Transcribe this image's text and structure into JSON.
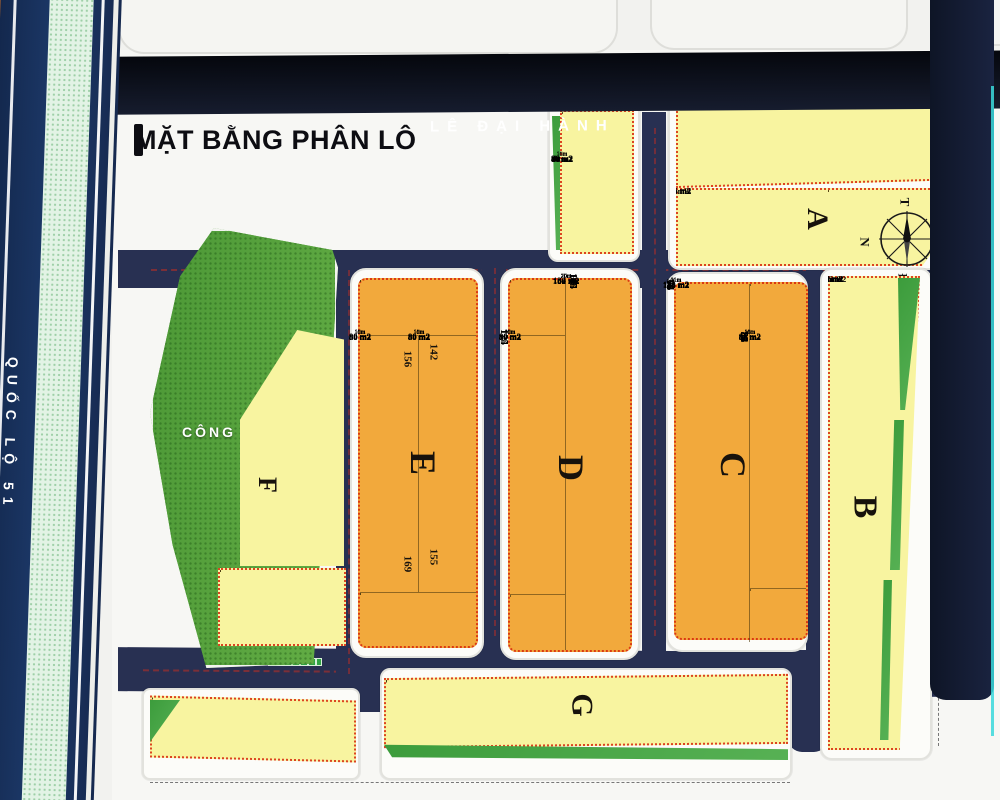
{
  "title": "MẶT BẰNG PHÂN LÔ",
  "streets": {
    "top": "LÊ ĐẠI HÀNH",
    "left": "QUỐC LỘ 51"
  },
  "park_label": "CÔNG VIÊN",
  "compass": {
    "top": "T",
    "right": "B",
    "bottom": "Đ",
    "left": "N"
  },
  "blocks": {
    "b1": {
      "top": [
        "|1",
        "100 m2",
        "100 m2",
        "92 m2|3"
      ],
      "rows": [
        "80 m2|4",
        "80 m2",
        "80 m2",
        "80 m2",
        "88m2|8"
      ]
    },
    "A": {
      "letter": "A",
      "top": [
        "118.5 m2|9",
        "105 m2",
        "105 m2",
        "105 m2",
        "115 m2",
        "115 m2",
        "115 m2",
        "115 m2",
        "110 m2",
        "107 m2",
        "105 m2",
        "102 m2",
        "101 m2|21"
      ],
      "rows": [
        "105 m2|26",
        "105 m2|25",
        "105 m2",
        "105 m2",
        "97 m2|30"
      ],
      "right": [
        "|22",
        "115 m2",
        "115 m2",
        "115 m2",
        "132 m2"
      ]
    },
    "B": {
      "letter": "B",
      "lots": [
        "230 m2|31",
        "150 m2",
        "150 m2",
        "150 m2",
        "150 m2",
        "150 m2",
        "125 m2|38",
        "125 m2",
        "125 m2|39",
        "125 m2",
        "125 m2",
        "125 m2",
        "125 m2",
        "137.5 m2",
        "105 m2",
        "105 m2",
        "105 m2",
        "105 m2",
        "105 m2",
        "105 m2|50",
        "90 m2|51",
        "90 m2",
        "90 m2",
        "90 m2",
        "95 m2|55"
      ]
    },
    "C": {
      "letter": "C",
      "left": [
        "140 m2|56",
        "105 m2",
        "105 m2",
        "105 m2",
        "105 m2",
        "105 m2",
        "105 m2",
        "105 m2",
        "105 m2|64",
        "105 m2|65",
        "105 m2",
        "105 m2",
        "105 m2",
        "105 m2",
        "105 m2",
        "105 m2",
        "105 m2",
        "105 m2",
        "105 m2",
        "140 m2|75"
      ],
      "rtop": [
        "85 m2|76",
        "85 m2",
        "95 m2|78"
      ],
      "right": [
        "80 m2|79",
        "80 m2",
        "80 m2",
        "80 m2",
        "80 m2",
        "80 m2|84",
        "80 m2|85",
        "80 m2",
        "80 m2",
        "80 m2",
        "80 m2",
        "80 m2",
        "80 m2|92",
        "80 m2"
      ],
      "rbottom": [
        "85 m2|95",
        "85 m2",
        "95 m2|93"
      ]
    },
    "D": {
      "letter": "D",
      "ltop": [
        "94 m2|116a",
        "85 m2",
        "85 m2|118a",
        "|119"
      ],
      "left": [
        "80 m2",
        "80 m2",
        "80 m2",
        "80 m2",
        "80 m2",
        "80 m2|124",
        "80 m2|125",
        "80 m2",
        "80 m2",
        "80 m2",
        "80 m2",
        "80 m2",
        "80 m2",
        "80 m2"
      ],
      "lbottom": [
        "94 m2|135a",
        "85 m2|133",
        "85 m2|132"
      ],
      "right": [
        "132 m2|96",
        "100 m2",
        "100 m2",
        "100 m2",
        "100 m2",
        "100 m2",
        "100 m2",
        "100 m2",
        "100 m2|104",
        "100 m2|105",
        "100 m2",
        "100 m2",
        "100 m2",
        "100 m2",
        "100 m2",
        "100 m2",
        "100 m2",
        "100 m2",
        "132 m2|115"
      ]
    },
    "E": {
      "letter": "E",
      "top": [
        "106 m2|136a",
        "95 m2",
        "95 m2",
        "95 m2",
        "95 m2",
        "106 m2|141a"
      ],
      "left": [
        "80 m2",
        "80 m2",
        "80 m2",
        "80 m2",
        "80 m2",
        "80 m2",
        "80 m2",
        "80 m2",
        "80 m2",
        "80 m2",
        "80 m2",
        "80 m2",
        "80 m2"
      ],
      "right": [
        "80 m2",
        "80 m2",
        "80 m2",
        "80 m2",
        "80 m2",
        "80 m2",
        "80 m2",
        "80 m2",
        "80 m2",
        "80 m2",
        "80 m2",
        "80 m2",
        "80 m2"
      ],
      "nums": {
        "n1": "156",
        "n2": "142",
        "n3": "169",
        "n4": "155"
      },
      "bottom": [
        "106 m2|175",
        "95 m2",
        "95 m2",
        "95 m2",
        "106 m2|170"
      ]
    },
    "F": {
      "letter": "F",
      "col": [
        "68 m2|176",
        "82 m2",
        "80 m2",
        "90.6 m2",
        "100 m2",
        "111 m2",
        "121 m2",
        "131 m2",
        "142 m2",
        "152 m2",
        "159 m2",
        "160 m2",
        "160 m2",
        "160 m2"
      ],
      "dims": [
        "10.1m",
        "12.5m",
        "15m",
        "17.1m",
        "19.2m",
        "21.2m",
        "23.3m",
        "25.4m",
        "27.4m",
        "28.5m",
        "31.6m",
        "32m",
        "32m",
        "32m"
      ],
      "bottom": [
        "|196",
        "100 m2",
        "100 m2",
        "100 m2",
        "110 m2",
        "110 m2",
        "110 m2",
        "102 m2|190",
        "|189"
      ]
    },
    "G": {
      "letter": "G",
      "cells": [
        "132 m2|209",
        "100 m2",
        "100 m2",
        "100 m2",
        "100 m2",
        "100 m2",
        "100 m2",
        "|215",
        "GAP",
        "|216",
        "100 m2",
        "100 m2",
        "100 m2",
        "100 m2",
        "100 m2",
        "|224",
        "100 m2",
        "100 m2",
        "|225",
        "GAP",
        "100 m2",
        "100 m2",
        "100 m2",
        "100 m2",
        "132 m2|231"
      ]
    },
    "BL": {
      "cells": [
        "170 m2|197",
        "92.5 m2",
        "92.5 m2",
        "92.5 m2",
        "92.5 m2",
        "92.5 m2",
        "92.5 m2",
        "92.5 m2",
        "92.5 m2",
        "92.5 m2",
        "92.5 m2",
        "92.5 m2",
        "|208"
      ]
    }
  }
}
